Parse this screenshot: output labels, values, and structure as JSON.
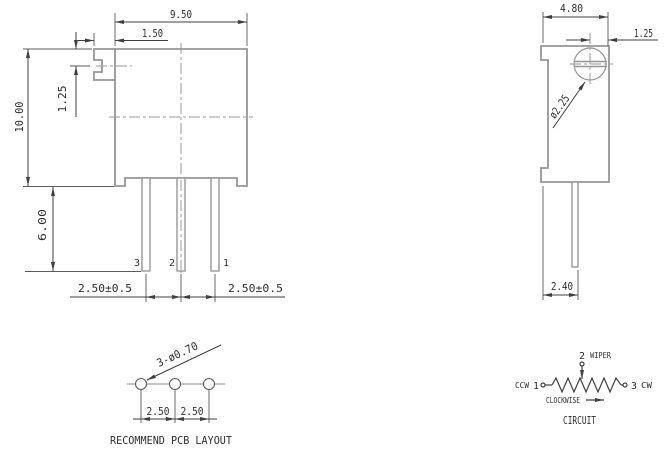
{
  "front_view": {
    "dim_body_width": "9.50",
    "dim_screw_tab": "1.50",
    "dim_body_height": "10.00",
    "dim_slot_offset": "1.25",
    "dim_pin_length": "6.00",
    "dim_pin_pitch_left": "2.50±0.5",
    "dim_pin_pitch_right": "2.50±0.5",
    "pin_labels": [
      "3",
      "2",
      "1"
    ]
  },
  "side_view": {
    "dim_body_depth": "4.80",
    "dim_screw_inset": "1.25",
    "dim_screw_diameter": "ø2.25",
    "dim_pin_offset": "2.40"
  },
  "pcb_layout": {
    "hole_callout": "3-ø0.70",
    "dim_pitch_1": "2.50",
    "dim_pitch_2": "2.50",
    "title": "RECOMMEND PCB LAYOUT"
  },
  "circuit": {
    "wiper_num": "2",
    "wiper_label": "WIPER",
    "ccw_label": "CCW",
    "ccw_num": "1",
    "cw_num": "3",
    "cw_label": "CW",
    "rotation_label": "CLOCKWISE",
    "title": "CIRCUIT"
  },
  "colors": {
    "background": "#ffffff",
    "part_outline": "#969696",
    "dimension_line": "#3f3f3f",
    "text": "#2e2e2e",
    "centerline": "#9a9a9a"
  }
}
